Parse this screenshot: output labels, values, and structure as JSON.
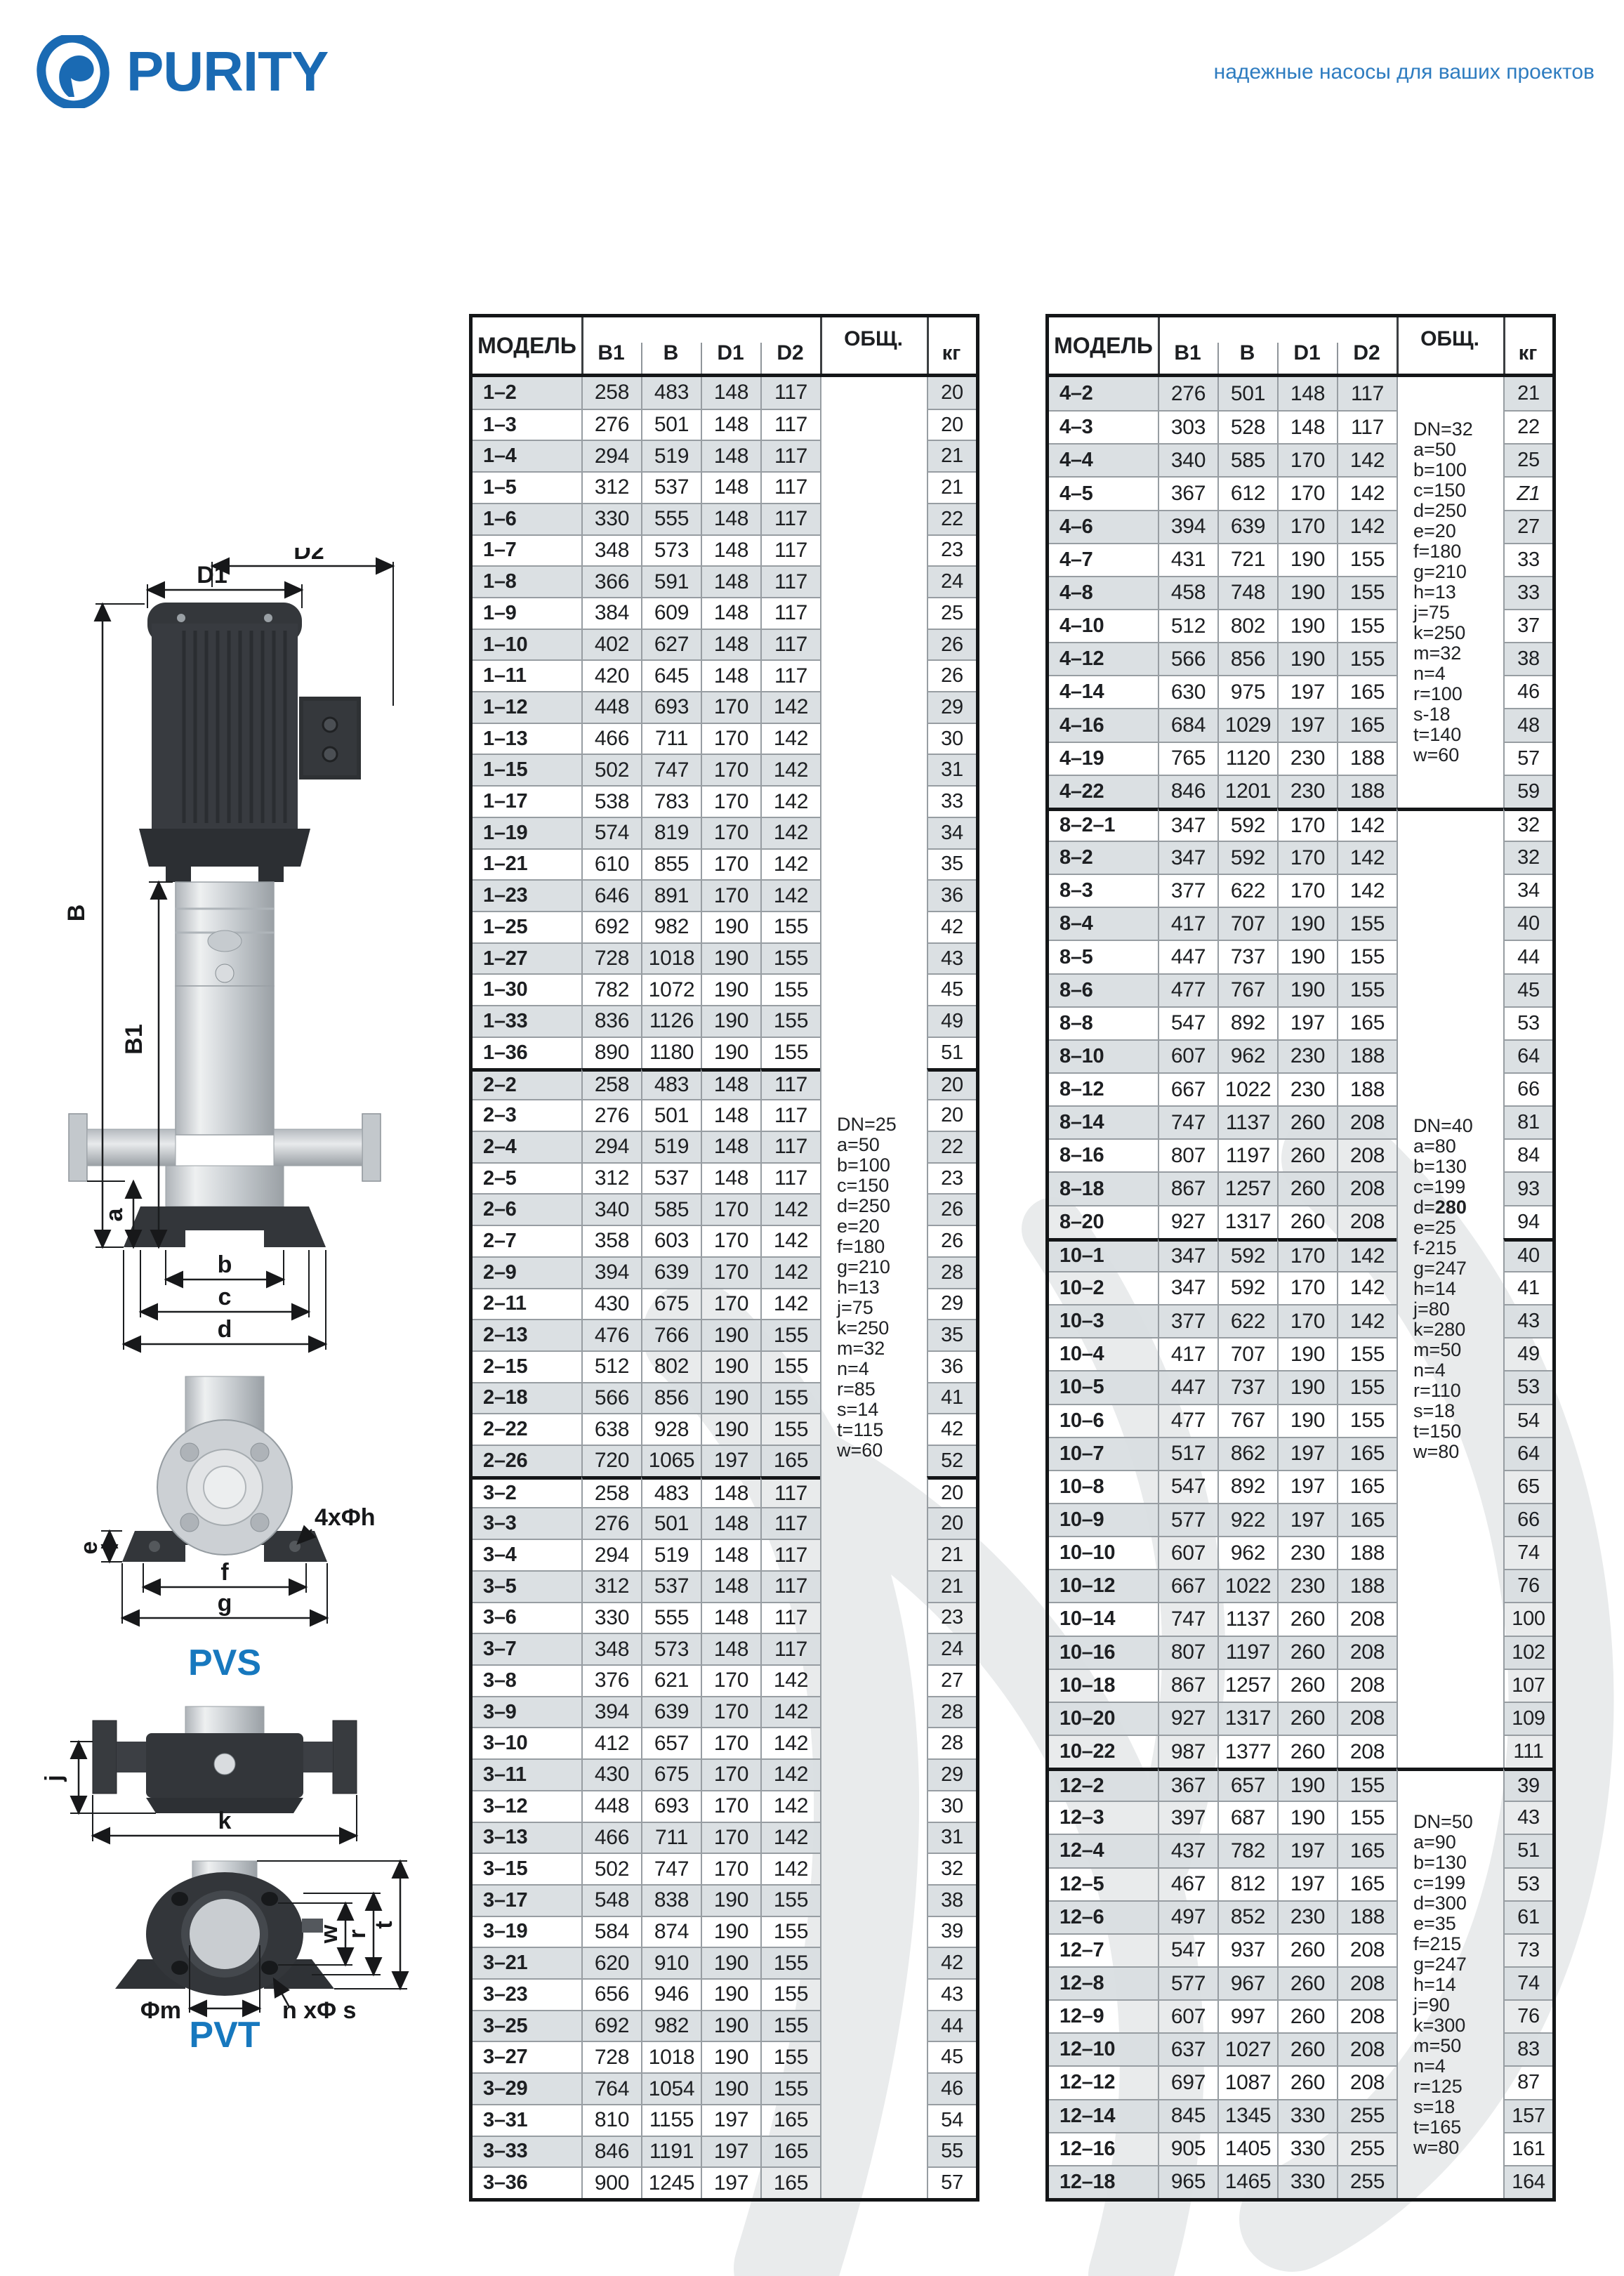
{
  "header": {
    "logo_text": "PURITY",
    "tagline": "надежные насосы для ваших проектов"
  },
  "diagram": {
    "pvs_label": "PVS",
    "pvt_label": "PVT",
    "dims": {
      "d1": "D1",
      "d2": "D2",
      "b_total": "B",
      "b1": "B1",
      "a": "a",
      "b": "b",
      "c": "c",
      "d": "d",
      "holes": "4xΦh",
      "e": "e",
      "f": "f",
      "g": "g",
      "j": "j",
      "k": "k",
      "w": "w",
      "r": "r",
      "t": "t",
      "phi_m": "Φm",
      "n_phi_s": "n xΦ s"
    }
  },
  "tables": [
    {
      "id": "left",
      "headers": {
        "model": "МОДЕЛЬ",
        "b1": "B1",
        "b": "B",
        "d1": "D1",
        "d2": "D2",
        "total": "ОБЩ.",
        "kg": "кг"
      },
      "groups": [
        {
          "rows": [
            [
              "1–2",
              258,
              483,
              148,
              117,
              20
            ],
            [
              "1–3",
              276,
              501,
              148,
              117,
              20
            ],
            [
              "1–4",
              294,
              519,
              148,
              117,
              21
            ],
            [
              "1–5",
              312,
              537,
              148,
              117,
              21
            ],
            [
              "1–6",
              330,
              555,
              148,
              117,
              22
            ],
            [
              "1–7",
              348,
              573,
              148,
              117,
              23
            ],
            [
              "1–8",
              366,
              591,
              148,
              117,
              24
            ],
            [
              "1–9",
              384,
              609,
              148,
              117,
              25
            ],
            [
              "1–10",
              402,
              627,
              148,
              117,
              26
            ],
            [
              "1–11",
              420,
              645,
              148,
              117,
              26
            ],
            [
              "1–12",
              448,
              693,
              170,
              142,
              29
            ],
            [
              "1–13",
              466,
              711,
              170,
              142,
              30
            ],
            [
              "1–15",
              502,
              747,
              170,
              142,
              31
            ],
            [
              "1–17",
              538,
              783,
              170,
              142,
              33
            ],
            [
              "1–19",
              574,
              819,
              170,
              142,
              34
            ],
            [
              "1–21",
              610,
              855,
              170,
              142,
              35
            ],
            [
              "1–23",
              646,
              891,
              170,
              142,
              36
            ],
            [
              "1–25",
              692,
              982,
              190,
              155,
              42
            ],
            [
              "1–27",
              728,
              1018,
              190,
              155,
              43
            ],
            [
              "1–30",
              782,
              1072,
              190,
              155,
              45
            ],
            [
              "1–33",
              836,
              1126,
              190,
              155,
              49
            ],
            [
              "1–36",
              890,
              1180,
              190,
              155,
              51
            ]
          ]
        },
        {
          "rows": [
            [
              "2–2",
              258,
              483,
              148,
              117,
              20
            ],
            [
              "2–3",
              276,
              501,
              148,
              117,
              20
            ],
            [
              "2–4",
              294,
              519,
              148,
              117,
              22
            ],
            [
              "2–5",
              312,
              537,
              148,
              117,
              23
            ],
            [
              "2–6",
              340,
              585,
              170,
              142,
              26
            ],
            [
              "2–7",
              358,
              603,
              170,
              142,
              26
            ],
            [
              "2–9",
              394,
              639,
              170,
              142,
              28
            ],
            [
              "2–11",
              430,
              675,
              170,
              142,
              29
            ],
            [
              "2–13",
              476,
              766,
              190,
              155,
              35
            ],
            [
              "2–15",
              512,
              802,
              190,
              155,
              36
            ],
            [
              "2–18",
              566,
              856,
              190,
              155,
              41
            ],
            [
              "2–22",
              638,
              928,
              190,
              155,
              42
            ],
            [
              "2–26",
              720,
              1065,
              197,
              165,
              52
            ]
          ]
        },
        {
          "rows": [
            [
              "3–2",
              258,
              483,
              148,
              117,
              20
            ],
            [
              "3–3",
              276,
              501,
              148,
              117,
              20
            ],
            [
              "3–4",
              294,
              519,
              148,
              117,
              21
            ],
            [
              "3–5",
              312,
              537,
              148,
              117,
              21
            ],
            [
              "3–6",
              330,
              555,
              148,
              117,
              23
            ],
            [
              "3–7",
              348,
              573,
              148,
              117,
              24
            ],
            [
              "3–8",
              376,
              621,
              170,
              142,
              27
            ],
            [
              "3–9",
              394,
              639,
              170,
              142,
              28
            ],
            [
              "3–10",
              412,
              657,
              170,
              142,
              28
            ],
            [
              "3–11",
              430,
              675,
              170,
              142,
              29
            ],
            [
              "3–12",
              448,
              693,
              170,
              142,
              30
            ],
            [
              "3–13",
              466,
              711,
              170,
              142,
              31
            ],
            [
              "3–15",
              502,
              747,
              170,
              142,
              32
            ],
            [
              "3–17",
              548,
              838,
              190,
              155,
              38
            ],
            [
              "3–19",
              584,
              874,
              190,
              155,
              39
            ],
            [
              "3–21",
              620,
              910,
              190,
              155,
              42
            ],
            [
              "3–23",
              656,
              946,
              190,
              155,
              43
            ],
            [
              "3–25",
              692,
              982,
              190,
              155,
              44
            ],
            [
              "3–27",
              728,
              1018,
              190,
              155,
              45
            ],
            [
              "3–29",
              764,
              1054,
              190,
              155,
              46
            ],
            [
              "3–31",
              810,
              1155,
              197,
              165,
              54
            ],
            [
              "3–33",
              846,
              1191,
              197,
              165,
              55
            ],
            [
              "3–36",
              900,
              1245,
              197,
              165,
              57
            ]
          ]
        }
      ],
      "notes": [
        {
          "from_group": 0,
          "to_group": 2,
          "lines": [
            "DN=25",
            "a=50",
            "b=100",
            "c=150",
            "d=250",
            "e=20",
            "f=180",
            "g=210",
            "h=13",
            "j=75",
            "k=250",
            "m=32",
            "n=4",
            "r=85",
            "s=14",
            "t=115",
            "w=60"
          ]
        }
      ]
    },
    {
      "id": "right",
      "headers": {
        "model": "МОДЕЛЬ",
        "b1": "B1",
        "b": "B",
        "d1": "D1",
        "d2": "D2",
        "total": "ОБЩ.",
        "kg": "кг"
      },
      "groups": [
        {
          "rows": [
            [
              "4–2",
              276,
              501,
              148,
              117,
              21
            ],
            [
              "4–3",
              303,
              528,
              148,
              117,
              22
            ],
            [
              "4–4",
              340,
              585,
              170,
              142,
              25
            ],
            [
              "4–5",
              367,
              612,
              170,
              142,
              "Z1"
            ],
            [
              "4–6",
              394,
              639,
              170,
              142,
              27
            ],
            [
              "4–7",
              431,
              721,
              190,
              155,
              33
            ],
            [
              "4–8",
              458,
              748,
              190,
              155,
              33
            ],
            [
              "4–10",
              512,
              802,
              190,
              155,
              37
            ],
            [
              "4–12",
              566,
              856,
              190,
              155,
              38
            ],
            [
              "4–14",
              630,
              975,
              197,
              165,
              46
            ],
            [
              "4–16",
              684,
              1029,
              197,
              165,
              48
            ],
            [
              "4–19",
              765,
              1120,
              230,
              188,
              57
            ],
            [
              "4–22",
              846,
              1201,
              230,
              188,
              59
            ]
          ]
        },
        {
          "rows": [
            [
              "8–2–1",
              347,
              592,
              170,
              142,
              32
            ],
            [
              "8–2",
              347,
              592,
              170,
              142,
              32
            ],
            [
              "8–3",
              377,
              622,
              170,
              142,
              34
            ],
            [
              "8–4",
              417,
              707,
              190,
              155,
              40
            ],
            [
              "8–5",
              447,
              737,
              190,
              155,
              44
            ],
            [
              "8–6",
              477,
              767,
              190,
              155,
              45
            ],
            [
              "8–8",
              547,
              892,
              197,
              165,
              53
            ],
            [
              "8–10",
              607,
              962,
              230,
              188,
              64
            ],
            [
              "8–12",
              667,
              1022,
              230,
              188,
              66
            ],
            [
              "8–14",
              747,
              1137,
              260,
              208,
              81
            ],
            [
              "8–16",
              807,
              1197,
              260,
              208,
              84
            ],
            [
              "8–18",
              867,
              1257,
              260,
              208,
              93
            ],
            [
              "8–20",
              927,
              1317,
              260,
              208,
              94
            ]
          ]
        },
        {
          "rows": [
            [
              "10–1",
              347,
              592,
              170,
              142,
              40
            ],
            [
              "10–2",
              347,
              592,
              170,
              142,
              41
            ],
            [
              "10–3",
              377,
              622,
              170,
              142,
              43
            ],
            [
              "10–4",
              417,
              707,
              190,
              155,
              49
            ],
            [
              "10–5",
              447,
              737,
              190,
              155,
              53
            ],
            [
              "10–6",
              477,
              767,
              190,
              155,
              54
            ],
            [
              "10–7",
              517,
              862,
              197,
              165,
              64
            ],
            [
              "10–8",
              547,
              892,
              197,
              165,
              65
            ],
            [
              "10–9",
              577,
              922,
              197,
              165,
              66
            ],
            [
              "10–10",
              607,
              962,
              230,
              188,
              74
            ],
            [
              "10–12",
              667,
              1022,
              230,
              188,
              76
            ],
            [
              "10–14",
              747,
              1137,
              260,
              208,
              100
            ],
            [
              "10–16",
              807,
              1197,
              260,
              208,
              102
            ],
            [
              "10–18",
              867,
              1257,
              260,
              208,
              107
            ],
            [
              "10–20",
              927,
              1317,
              260,
              208,
              109
            ],
            [
              "10–22",
              987,
              1377,
              260,
              208,
              111
            ]
          ]
        },
        {
          "rows": [
            [
              "12–2",
              367,
              657,
              190,
              155,
              39
            ],
            [
              "12–3",
              397,
              687,
              190,
              155,
              43
            ],
            [
              "12–4",
              437,
              782,
              197,
              165,
              51
            ],
            [
              "12–5",
              467,
              812,
              197,
              165,
              53
            ],
            [
              "12–6",
              497,
              852,
              230,
              188,
              61
            ],
            [
              "12–7",
              547,
              937,
              260,
              208,
              73
            ],
            [
              "12–8",
              577,
              967,
              260,
              208,
              74
            ],
            [
              "12–9",
              607,
              997,
              260,
              208,
              76
            ],
            [
              "12–10",
              637,
              1027,
              260,
              208,
              83
            ],
            [
              "12–12",
              697,
              1087,
              260,
              208,
              87
            ],
            [
              "12–14",
              845,
              1345,
              330,
              255,
              157
            ],
            [
              "12–16",
              905,
              1405,
              330,
              255,
              161
            ],
            [
              "12–18",
              965,
              1465,
              330,
              255,
              164
            ]
          ]
        }
      ],
      "notes": [
        {
          "from_group": 0,
          "to_group": 0,
          "lines": [
            "DN=32",
            "a=50",
            "b=100",
            "c=150",
            "d=250",
            "e=20",
            "f=180",
            "g=210",
            "h=13",
            "j=75",
            "k=250",
            "m=32",
            "n=4",
            "r=100",
            "s-18",
            "t=140",
            "w=60"
          ]
        },
        {
          "from_group": 1,
          "to_group": 2,
          "bold_value_lines": [
            4
          ],
          "lines": [
            "DN=40",
            "a=80",
            "b=130",
            "c=199",
            "d=280",
            "e=25",
            "f-215",
            "g=247",
            "h=14",
            "j=80",
            "k=280",
            "m=50",
            "n=4",
            "r=110",
            "s=18",
            "t=150",
            "w=80"
          ]
        },
        {
          "from_group": 3,
          "to_group": 3,
          "lines": [
            "DN=50",
            "a=90",
            "b=130",
            "c=199",
            "d=300",
            "e=35",
            "f=215",
            "g=247",
            "h=14",
            "j=90",
            "k=300",
            "m=50",
            "n=4",
            "r=125",
            "s=18",
            "t=165",
            "w=80"
          ]
        }
      ]
    }
  ]
}
